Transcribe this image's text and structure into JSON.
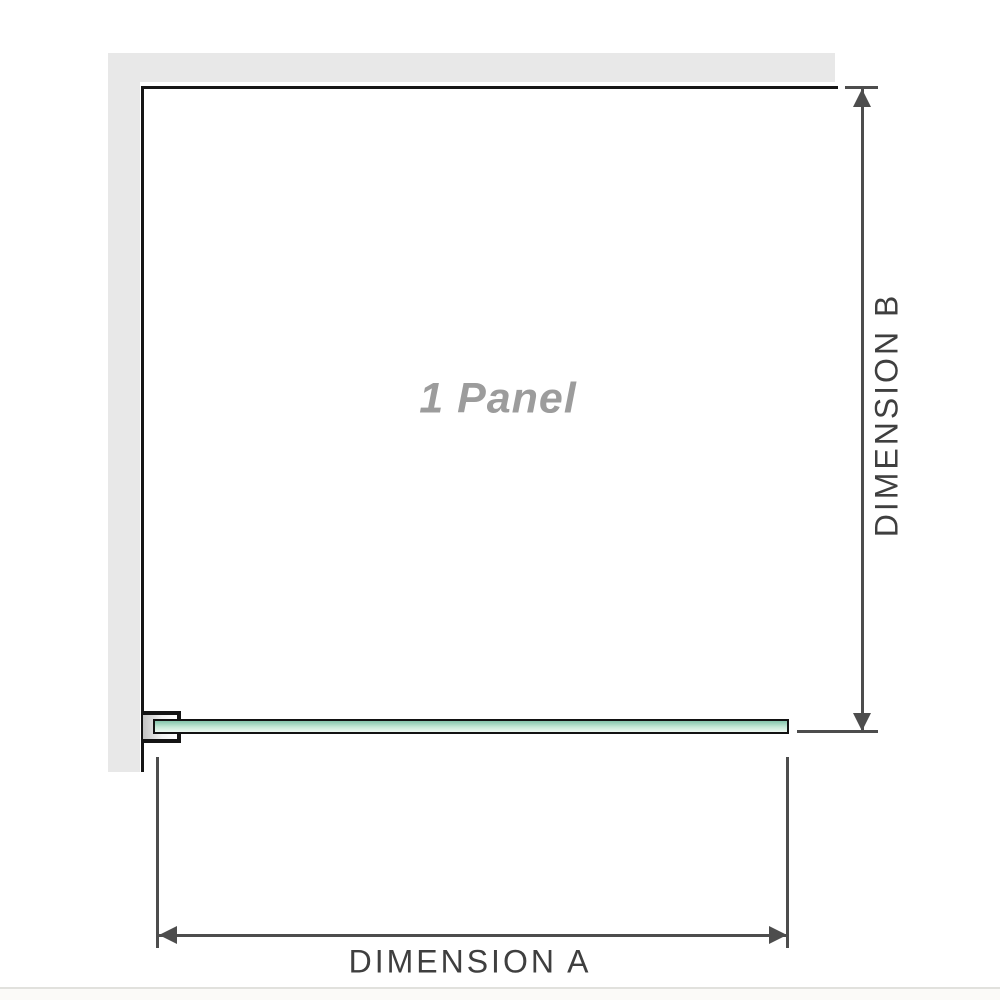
{
  "diagram": {
    "title": "Shower screen single panel dimension diagram",
    "panel_label": "1 Panel",
    "dimension_a_label": "DIMENSION A",
    "dimension_b_label": "DIMENSION B",
    "colors": {
      "wall_gray": "#e8e8e8",
      "frame_outline": "#161616",
      "dimension_line": "#4d4d4d",
      "dimension_text": "#3f3f3f",
      "panel_label_text": "#9c9c9c",
      "glass_green_top": "#84c5ab",
      "glass_green_mid": "#c6ead7",
      "glass_green_bottom": "#eef8f2"
    }
  }
}
